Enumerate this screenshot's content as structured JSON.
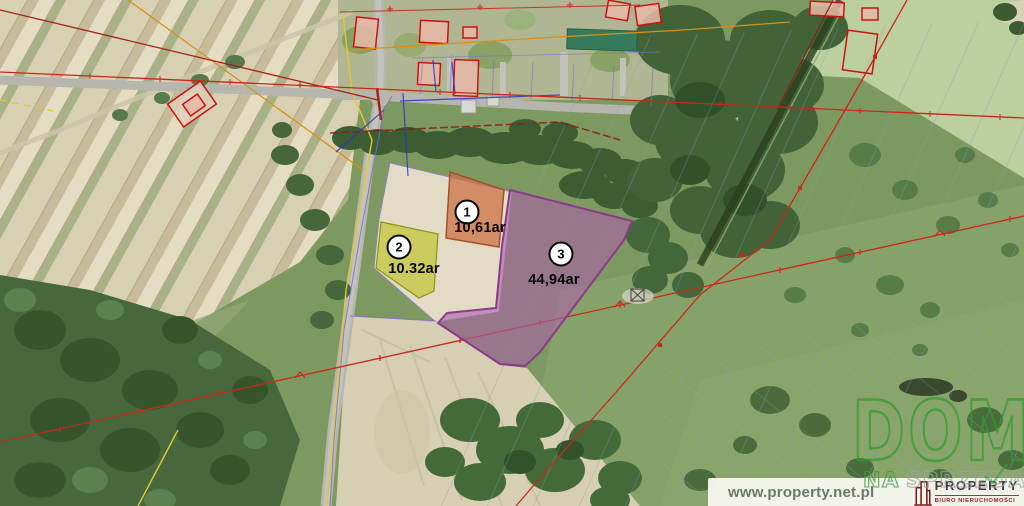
{
  "map": {
    "description": "aerial cadastral map with three highlighted land parcels",
    "parcels": [
      {
        "number": "1",
        "area": "10,61ar",
        "color": "#cc6f42"
      },
      {
        "number": "2",
        "area": "10.32ar",
        "color": "#bfc32e"
      },
      {
        "number": "3",
        "area": "44,94ar",
        "color": "#a963a5"
      }
    ]
  },
  "watermark": {
    "title": "DOM",
    "subtitle_accent": "NA",
    "subtitle_rest": "SPRZEDAŻ"
  },
  "footer": {
    "website": "www.property.net.pl",
    "brand_name": "PROPERTY",
    "brand_tagline": "BIURO NIERUCHOMOŚCI"
  },
  "colors": {
    "parcel_1_fill": "#cc6f42",
    "parcel_2_fill": "#bfc32e",
    "parcel_3_fill": "#a963a5",
    "parcel_3_border": "#8b3a8b",
    "cadastral_red": "#c8281c",
    "cadastral_violet": "#7b6fd0",
    "cadastral_yellow": "#e3c832",
    "cadastral_orange": "#d89018",
    "cadastral_blue": "#2a35c8",
    "watermark_green": "#2f9b2f",
    "brand_maroon": "#7c1b1b",
    "brand_red": "#9f2222"
  }
}
